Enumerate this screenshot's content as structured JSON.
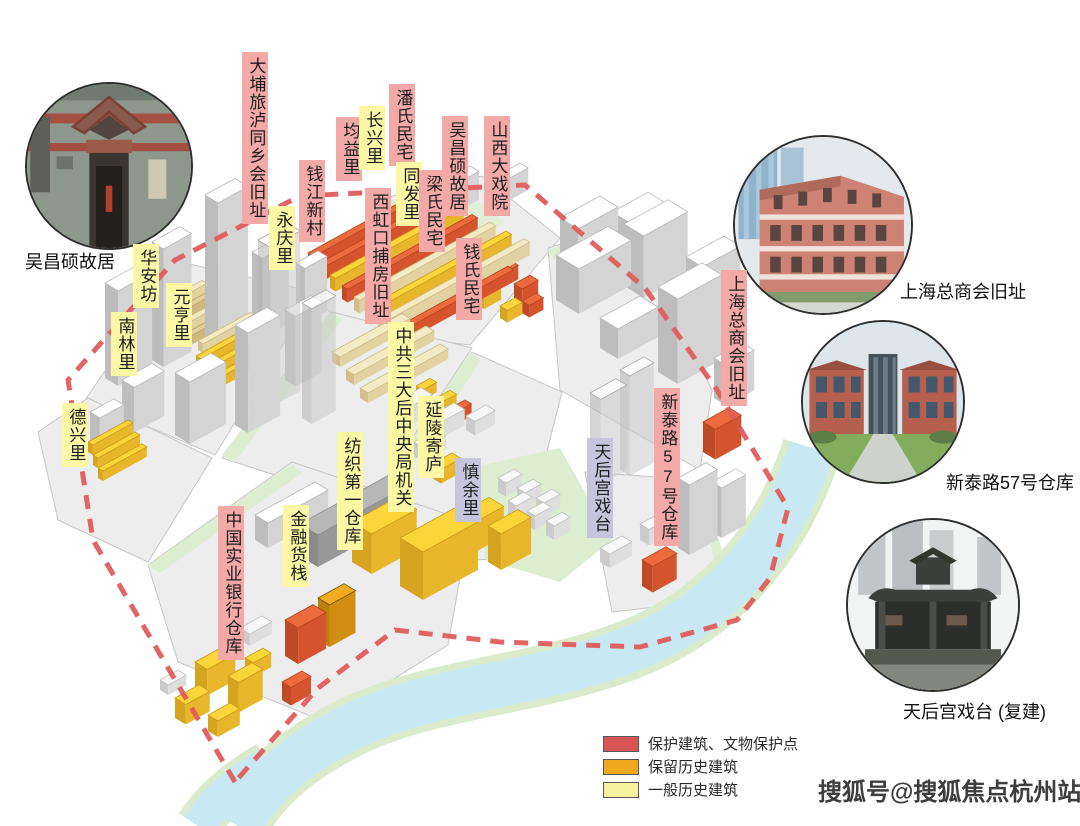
{
  "map_labels": [
    {
      "text": "大埔旅泸同乡会旧址",
      "type": "pink"
    },
    {
      "text": "钱江新村",
      "type": "pink"
    },
    {
      "text": "永庆里",
      "type": "yellow"
    },
    {
      "text": "均益里",
      "type": "pink"
    },
    {
      "text": "长兴里",
      "type": "yellow"
    },
    {
      "text": "潘氏民宅",
      "type": "pink"
    },
    {
      "text": "同发里",
      "type": "yellow"
    },
    {
      "text": "西虹口捕房旧址",
      "type": "pink"
    },
    {
      "text": "梁氏民宅",
      "type": "pink"
    },
    {
      "text": "吴昌硕故居",
      "type": "pink"
    },
    {
      "text": "山西大戏院",
      "type": "pink"
    },
    {
      "text": "钱氏民宅",
      "type": "pink"
    },
    {
      "text": "华安坊",
      "type": "yellow"
    },
    {
      "text": "元亨里",
      "type": "yellow"
    },
    {
      "text": "南林里",
      "type": "yellow"
    },
    {
      "text": "德兴里",
      "type": "yellow"
    },
    {
      "text": "中共三大后中央局机关",
      "type": "yellow"
    },
    {
      "text": "延陵寄庐",
      "type": "yellow"
    },
    {
      "text": "慎余里",
      "type": "lavender"
    },
    {
      "text": "纺织第一仓库",
      "type": "yellow"
    },
    {
      "text": "金融货栈",
      "type": "yellow"
    },
    {
      "text": "中国实业银行仓库",
      "type": "pink"
    },
    {
      "text": "天后宫戏台",
      "type": "lavender"
    },
    {
      "text": "新泰路57号仓库",
      "type": "pink"
    },
    {
      "text": "上海总商会旧址",
      "type": "pink"
    }
  ],
  "photos": [
    {
      "caption": "吴昌硕故居"
    },
    {
      "caption": "上海总商会旧址"
    },
    {
      "caption": "新泰路57号仓库"
    },
    {
      "caption": "天后宫戏台 (复建)"
    }
  ],
  "legend": {
    "items": [
      {
        "label": "保护建筑、文物保护点",
        "color": "#d95454"
      },
      {
        "label": "保留历史建筑",
        "color": "#f0a81e"
      },
      {
        "label": "一般历史建筑",
        "color": "#f6f2a0"
      }
    ]
  },
  "label_colors": {
    "pink": "#f2a9a7",
    "yellow": "#fbf7a4",
    "lavender": "#c7c5de"
  },
  "boundary_color": "#e25c5c",
  "river_color": "#c8e9f4",
  "watermark": "搜狐号@搜狐焦点杭州站"
}
